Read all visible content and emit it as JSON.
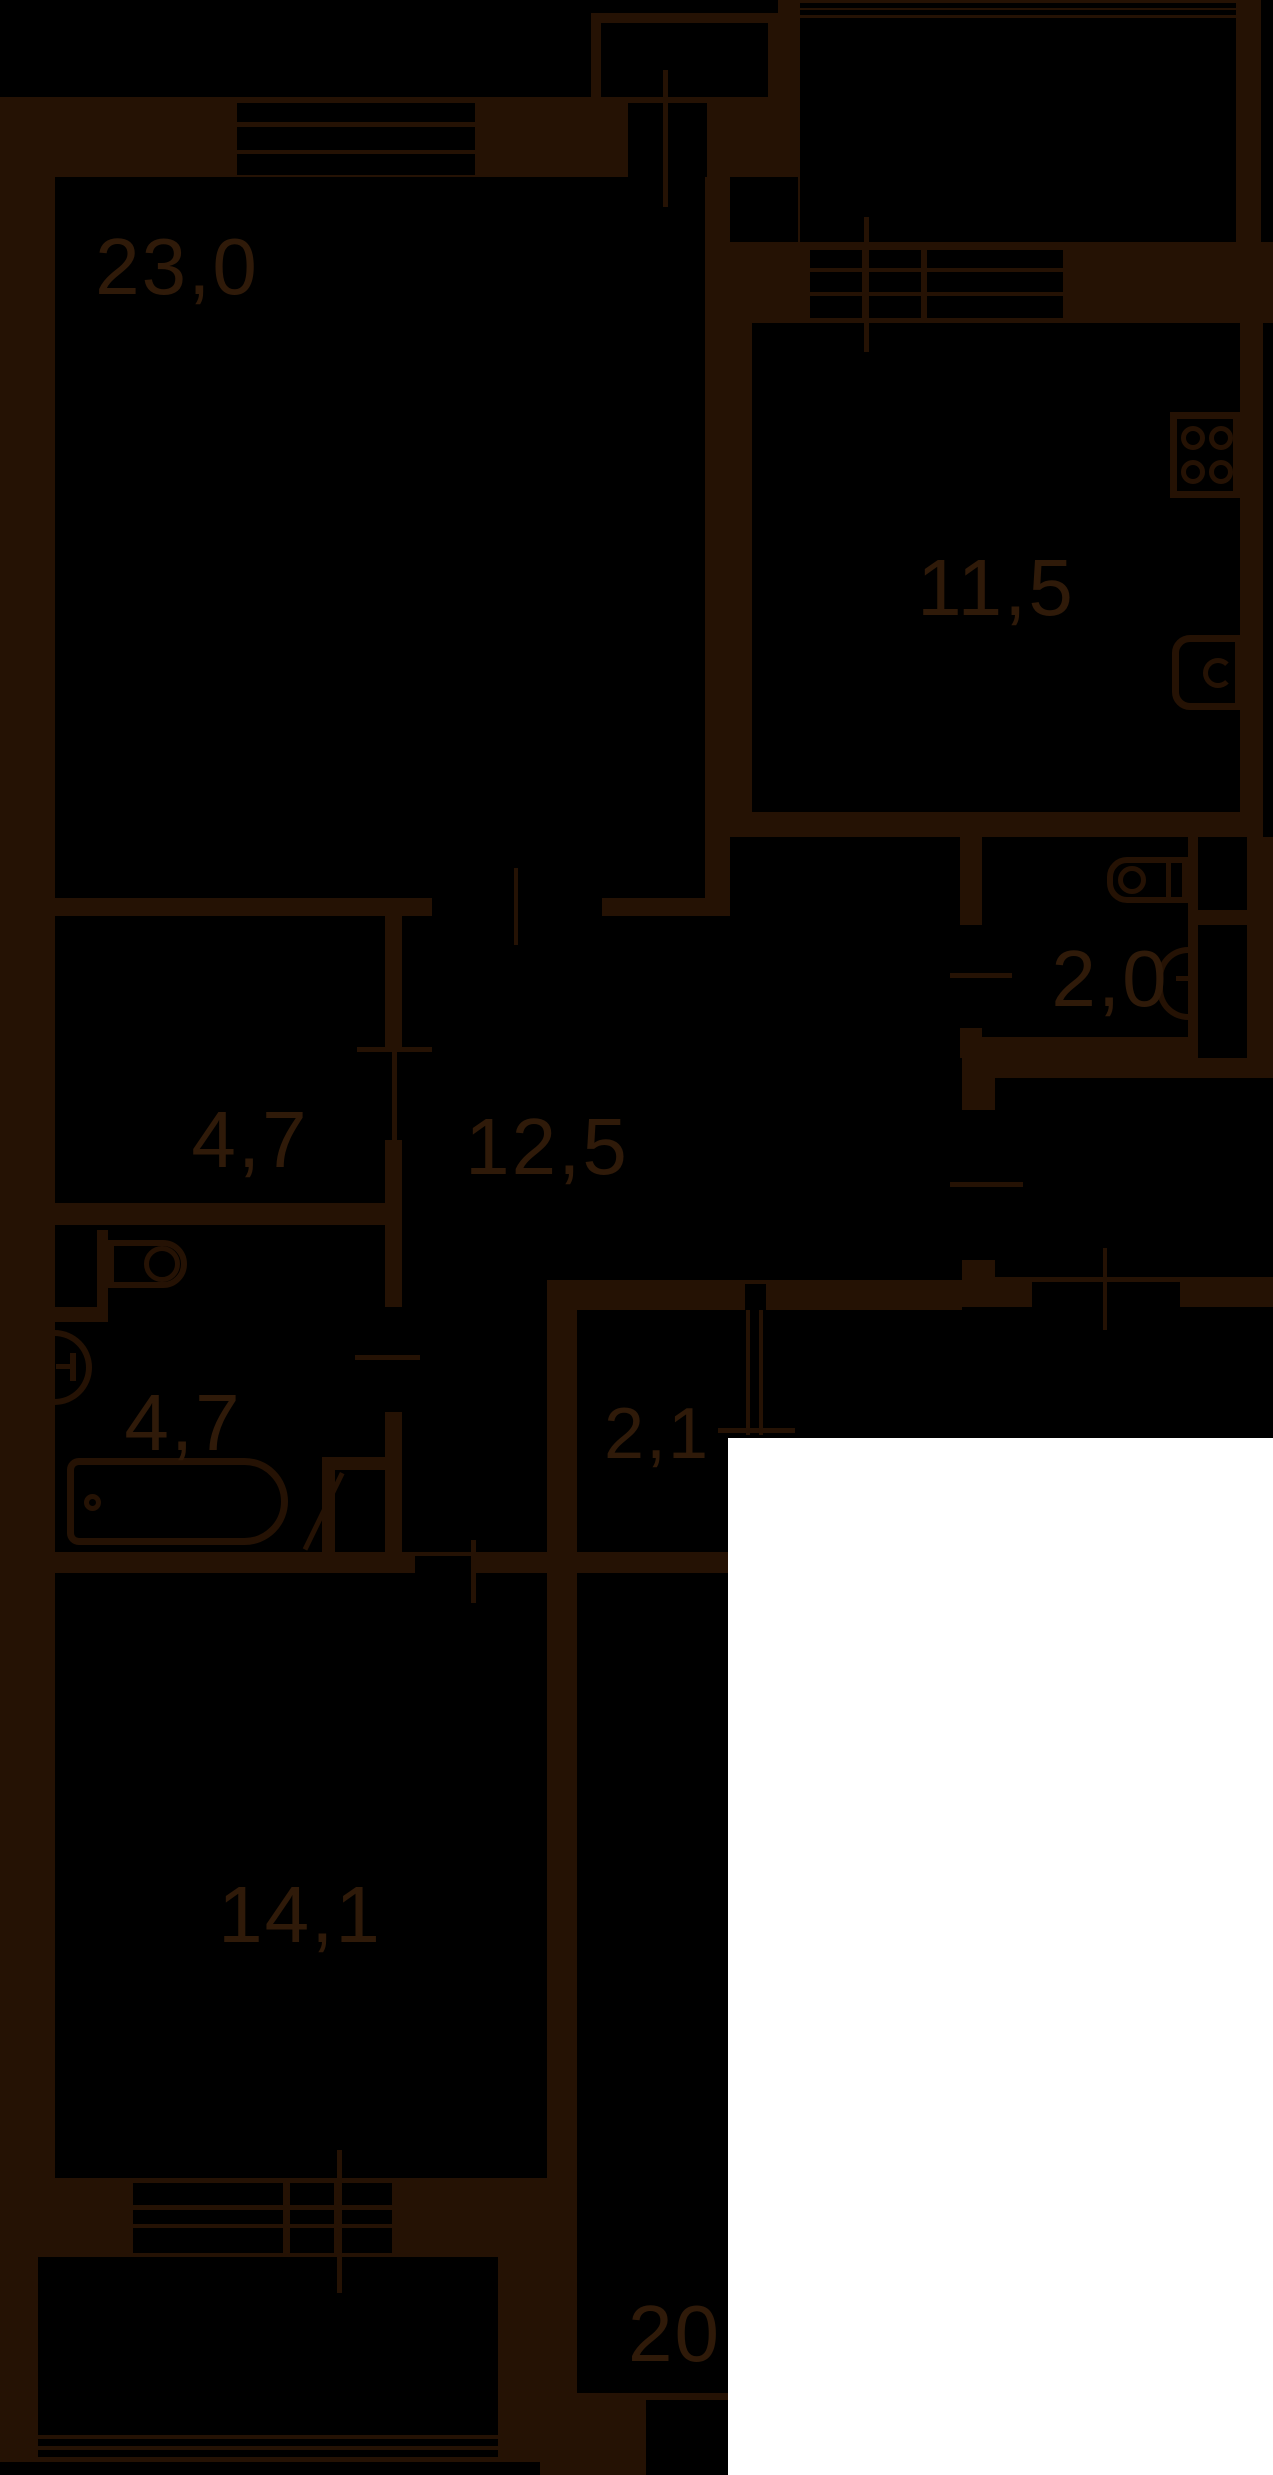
{
  "document_type": "apartment-floor-plan",
  "colors": {
    "bg": "#000000",
    "wall": "#251204",
    "text": "#2f1a09",
    "overlay": "#ffffff"
  },
  "rooms": [
    {
      "id": "living-room",
      "area_label": "23,0"
    },
    {
      "id": "kitchen",
      "area_label": "11,5"
    },
    {
      "id": "wc",
      "area_label": "2,0"
    },
    {
      "id": "storage",
      "area_label": "4,7"
    },
    {
      "id": "hallway",
      "area_label": "12,5"
    },
    {
      "id": "bathroom",
      "area_label": "4,7"
    },
    {
      "id": "niche",
      "area_label": "2,1"
    },
    {
      "id": "bedroom",
      "area_label": "14,1"
    },
    {
      "id": "room-20",
      "area_label": "20,"
    }
  ],
  "icons": [
    "stove-icon",
    "kitchen-sink-icon",
    "washing-machine-icon",
    "wc-sink-icon",
    "bathroom-sink-icon",
    "toilet-icon",
    "bathtub-icon",
    "door-leaf-icon",
    "window-icon"
  ]
}
